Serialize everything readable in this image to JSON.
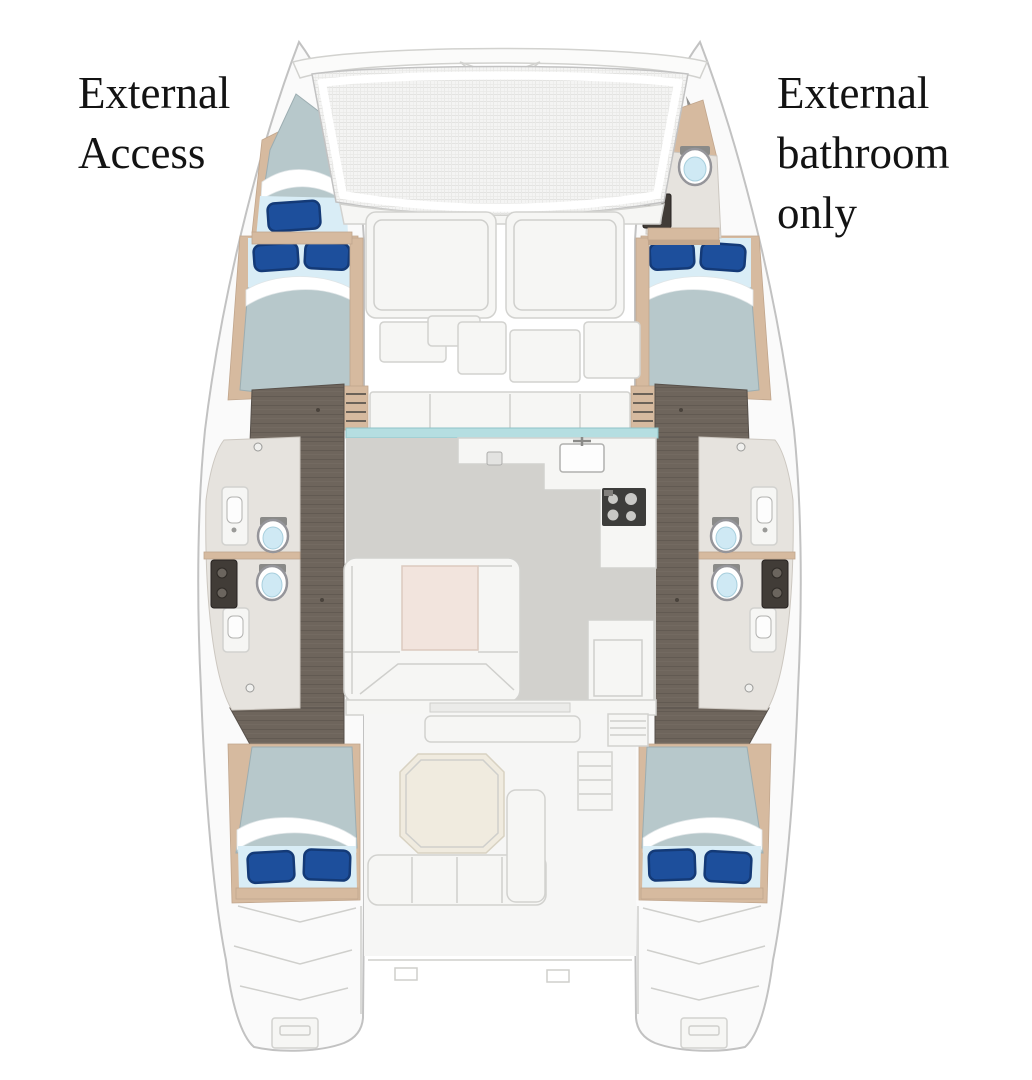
{
  "annotations": {
    "left": {
      "line1": "External",
      "line2": "Access"
    },
    "right": {
      "line1": "External",
      "line2": "bathroom",
      "line3": "only"
    }
  },
  "figure": {
    "type": "catamaran-deck-floorplan",
    "icons": [
      "toilet-icon",
      "sink-icon",
      "stove-icon",
      "bed-icon",
      "pillow-icon",
      "trampoline-mesh",
      "cockpit-table",
      "saloon-table",
      "transom-steps"
    ]
  },
  "palette": {
    "hull-fill": "#fafafa",
    "hull-stroke": "#c2c2c2",
    "wood-floor": "#6e655c",
    "wood-floor-dark": "#5a524a",
    "trim-tan": "#d6ba9f",
    "trim-tan-dark": "#c2a68c",
    "mattress": "#b7c8cb",
    "sheet-light": "#d9edf6",
    "pillow-blue": "#1d4f9c",
    "pillow-blue-dark": "#143a77",
    "bathroom-floor": "#e6e3de",
    "saloon-floor": "#d2d1cd",
    "window-teal": "#b5dee1",
    "table-beige": "#f2e4dd",
    "cockpit-table": "#f0ebdf",
    "counter-white": "#f6f6f4",
    "panel-stroke": "#d2d2cf",
    "toilet-water": "#cfe9f4",
    "dark-fixture": "#413c37",
    "mesh-gray": "#e3e3e1",
    "text-color": "#131313"
  }
}
